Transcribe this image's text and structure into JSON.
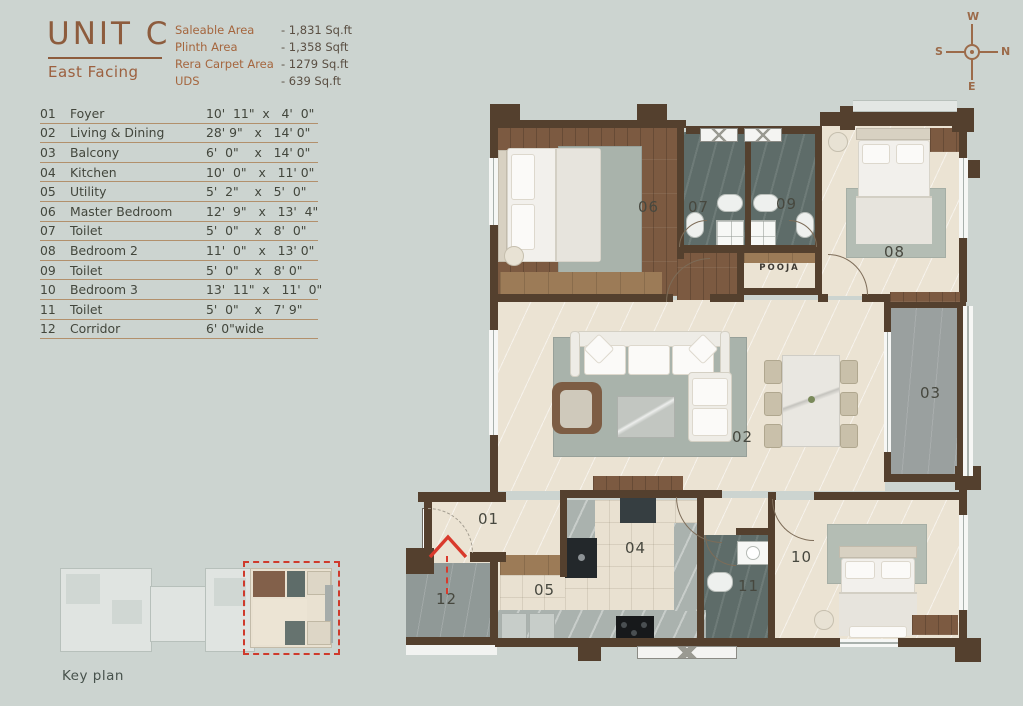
{
  "header": {
    "unit": "UNIT C",
    "facing": "East Facing",
    "specs": [
      {
        "label": "Saleable Area",
        "value": "- 1,831 Sq.ft"
      },
      {
        "label": "Plinth Area",
        "value": "- 1,358 Sqft"
      },
      {
        "label": "Rera Carpet Area",
        "value": "- 1279 Sq.ft"
      },
      {
        "label": "UDS",
        "value": "- 639 Sq.ft"
      }
    ]
  },
  "compass": {
    "top": "W",
    "right": "N",
    "left": "S",
    "bottom": "E"
  },
  "rooms": [
    {
      "no": "01",
      "name": "Foyer",
      "dim": "10'  11\"  x   4'  0\""
    },
    {
      "no": "02",
      "name": "Living & Dining",
      "dim": "28' 9\"   x   14' 0\""
    },
    {
      "no": "03",
      "name": "Balcony",
      "dim": "6'  0\"    x   14' 0\""
    },
    {
      "no": "04",
      "name": "Kitchen",
      "dim": "10'  0\"   x   11' 0\""
    },
    {
      "no": "05",
      "name": "Utility",
      "dim": "5'  2\"    x   5'  0\""
    },
    {
      "no": "06",
      "name": "Master Bedroom",
      "dim": "12'  9\"   x   13'  4\""
    },
    {
      "no": "07",
      "name": "Toilet",
      "dim": "5'  0\"    x   8'  0\""
    },
    {
      "no": "08",
      "name": "Bedroom 2",
      "dim": "11'  0\"   x   13' 0\""
    },
    {
      "no": "09",
      "name": "Toilet",
      "dim": "5'  0\"    x   8' 0\""
    },
    {
      "no": "10",
      "name": "Bedroom 3",
      "dim": "13'  11\"  x   11'  0\""
    },
    {
      "no": "11",
      "name": "Toilet",
      "dim": "5'  0\"    x   7' 9\""
    },
    {
      "no": "12",
      "name": "Corridor",
      "dim": "6' 0\"wide"
    }
  ],
  "plan": {
    "pooja": "POOJA"
  },
  "key_plan": {
    "label": "Key plan"
  },
  "colors": {
    "accent_brown": "#9c603f",
    "wall": "#54402e",
    "entry_red": "#d93a2c",
    "background": "#ccd4d0"
  }
}
